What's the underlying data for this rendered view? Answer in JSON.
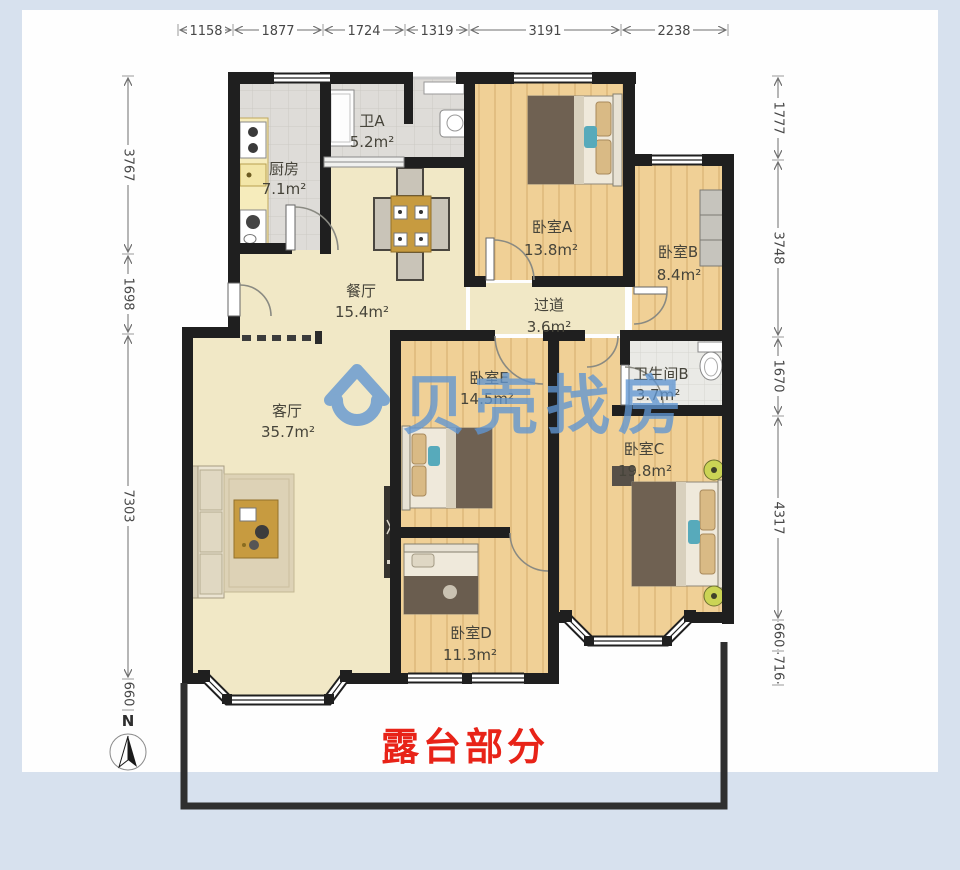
{
  "dimensions": {
    "top": [
      "1158",
      "1877",
      "1724",
      "1319",
      "3191",
      "2238"
    ],
    "left": [
      "3767",
      "1698",
      "7303",
      "660"
    ],
    "right": [
      "1777",
      "3748",
      "1670",
      "4317",
      "660",
      "716"
    ]
  },
  "rooms": [
    {
      "name": "厨房",
      "area": "7.1m²"
    },
    {
      "name": "卫A",
      "area": "5.2m²"
    },
    {
      "name": "餐厅",
      "area": "15.4m²"
    },
    {
      "name": "卧室A",
      "area": "13.8m²"
    },
    {
      "name": "卧室B",
      "area": "8.4m²"
    },
    {
      "name": "过道",
      "area": "3.6m²"
    },
    {
      "name": "卫生间B",
      "area": "3.7m²"
    },
    {
      "name": "客厅",
      "area": "35.7m²"
    },
    {
      "name": "卧室E",
      "area": "14.5m²"
    },
    {
      "name": "卧室C",
      "area": "19.8m²"
    },
    {
      "name": "卧室D",
      "area": "11.3m²"
    }
  ],
  "annotations": {
    "terrace_label": "露台部分",
    "terrace_color": "#e82318",
    "north_label": "N"
  },
  "watermark": {
    "text": "贝壳找房",
    "color": "#6096d2"
  }
}
